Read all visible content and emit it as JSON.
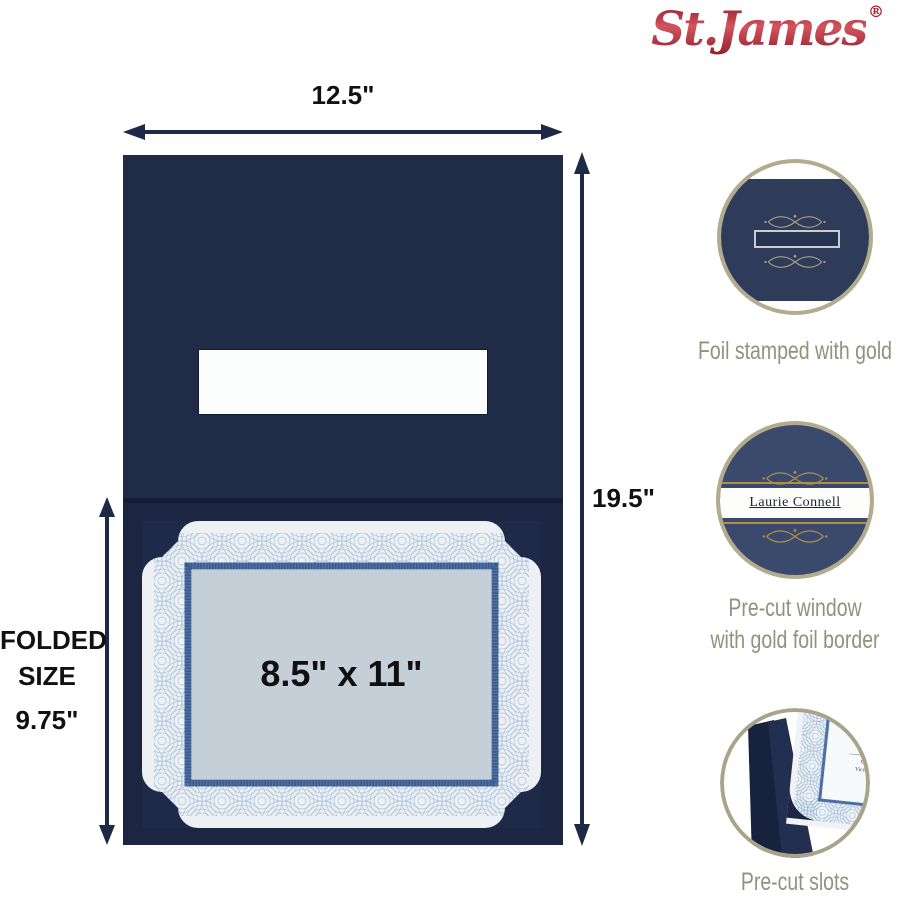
{
  "brand": {
    "name": "St.James",
    "registered": "®",
    "logo_color": "#a61e2c"
  },
  "colors": {
    "folder_navy_top": "#202b47",
    "folder_navy_bottom": "#1c2642",
    "arrow_navy": "#1e2a45",
    "ring_gold": "#b2ab8e",
    "foil_gold": "#b08c44",
    "caption_gray": "#92927f",
    "certificate_panel": "#c5cfd8",
    "guilloche_blue": "#a3bdda"
  },
  "diagram": {
    "width_label": "12.5\"",
    "height_label": "19.5\"",
    "folded": {
      "line1": "FOLDED",
      "line2": "SIZE",
      "value": "9.75\""
    },
    "insert_label": "8.5\" x 11\""
  },
  "callouts": {
    "foil": {
      "caption": "Foil stamped with gold"
    },
    "window": {
      "caption_line1": "Pre-cut window",
      "caption_line2": "with gold foil border",
      "name_text": "Laurie Connell"
    },
    "slots": {
      "caption": "Pre-cut slots",
      "cert_title_fragment": "W",
      "cert_line1": "Charles Abb",
      "cert_line2": "Vice President, Sa"
    }
  }
}
